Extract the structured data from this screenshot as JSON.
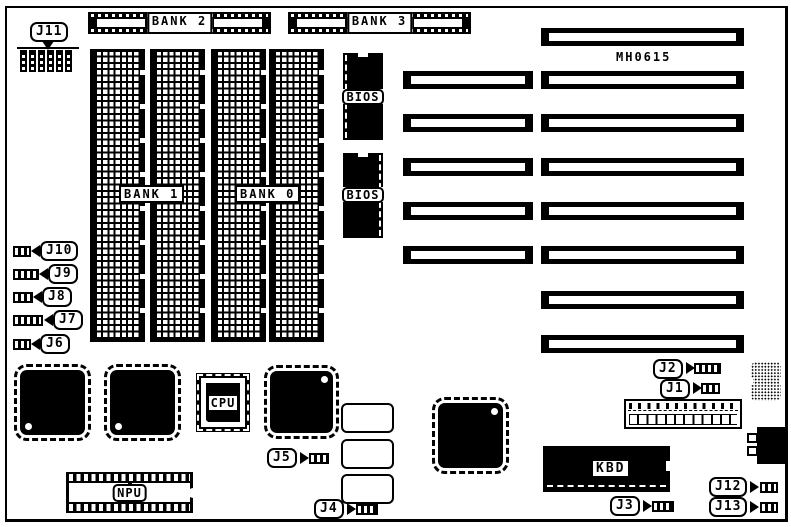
{
  "board": {
    "model_number": "MH0615",
    "colors": {
      "ink": "#000000",
      "background": "#ffffff"
    }
  },
  "memory": {
    "socket_row_labels": {
      "bank2": "BANK 2",
      "bank3": "BANK 3"
    },
    "array_labels": {
      "bank1": "BANK 1",
      "bank0": "BANK 0"
    },
    "dram_column_count": 4
  },
  "chips": {
    "bios_label": "BIOS",
    "cpu_label": "CPU",
    "npu_label": "NPU",
    "kbd_label": "KBD"
  },
  "jumpers": {
    "j1": "J1",
    "j2": "J2",
    "j3": "J3",
    "j4": "J4",
    "j5": "J5",
    "j6": "J6",
    "j7": "J7",
    "j8": "J8",
    "j9": "J9",
    "j10": "J10",
    "j11": "J11",
    "j12": "J12",
    "j13": "J13"
  },
  "expansion_slots": {
    "long_count": 8,
    "short_count": 5
  }
}
